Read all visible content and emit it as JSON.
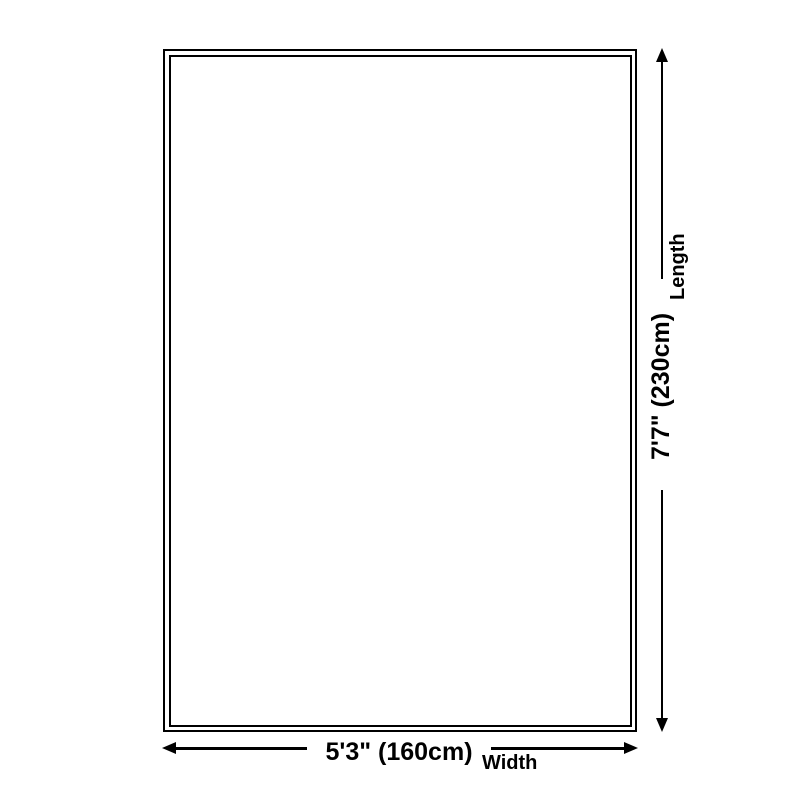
{
  "diagram": {
    "kind": "rug-size-diagram",
    "background_color": "#ffffff",
    "line_color": "#000000",
    "text_color": "#000000"
  },
  "length": {
    "label": "Length",
    "value": "7'7\" (230cm)"
  },
  "width": {
    "label": "Width",
    "value": "5'3\" (160cm)"
  }
}
